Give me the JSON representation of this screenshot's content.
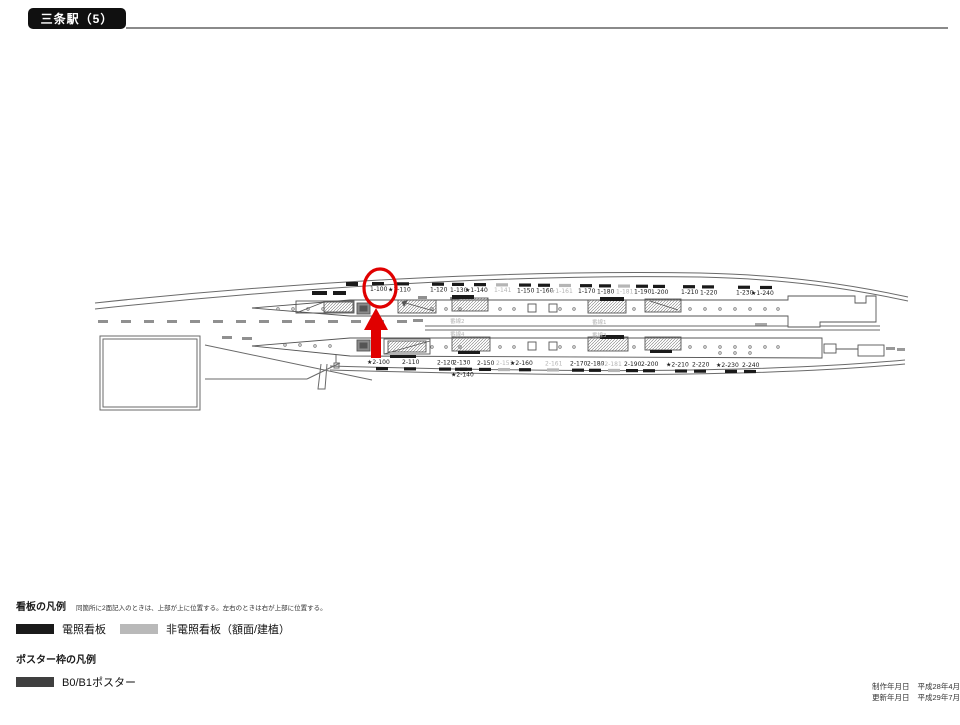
{
  "title": "三条駅（5）",
  "legend": {
    "signboard_heading": "看板の凡例",
    "signboard_note": "同箇所に2面記入のときは、上部が上に位置する。左右のときは右が上部に位置する。",
    "items": [
      {
        "label": "電照看板",
        "color": "#1a1a1a"
      },
      {
        "label": "非電照看板（額面/建植）",
        "color": "#b9b9b9"
      }
    ],
    "poster_heading": "ポスター枠の凡例",
    "poster_items": [
      {
        "label": "B0/B1ポスター",
        "color": "#3f3f3f"
      }
    ]
  },
  "footer": {
    "created_label": "制作年月日",
    "created_date": "平成28年4月 1日",
    "updated_label": "更新年月日",
    "updated_date": "平成29年7月12日"
  },
  "diagram": {
    "colors": {
      "billboard": "#1a1a1a",
      "non_lit": "#b5b5b5",
      "highlight": "#e00000"
    },
    "highlight": {
      "target": "1-100"
    },
    "track_labels": [
      {
        "text": "番線2",
        "x": 450,
        "y": 323
      },
      {
        "text": "番線1",
        "x": 592,
        "y": 324
      },
      {
        "text": "番線4",
        "x": 450,
        "y": 336
      },
      {
        "text": "番線3",
        "x": 592,
        "y": 337
      }
    ],
    "rows": [
      {
        "name": "row1",
        "baseY": 291,
        "x0": 370,
        "slope": 0.01,
        "tickdy": -9,
        "items": [
          {
            "id": "1-100",
            "x": 370
          },
          {
            "id": "1-110",
            "x": 395,
            "star": true
          },
          {
            "id": "1-120",
            "x": 430
          },
          {
            "id": "1-130",
            "x": 450
          },
          {
            "id": "1-140",
            "x": 472,
            "star": true
          },
          {
            "id": "1-141",
            "x": 494,
            "gray": true
          },
          {
            "id": "1-150",
            "x": 517
          },
          {
            "id": "1-160",
            "x": 536
          },
          {
            "id": "1-161",
            "x": 557,
            "star": true,
            "gray": true
          },
          {
            "id": "1-170",
            "x": 578
          },
          {
            "id": "1-180",
            "x": 597
          },
          {
            "id": "1-181",
            "x": 616,
            "gray": true
          },
          {
            "id": "1-190",
            "x": 634
          },
          {
            "id": "1-200",
            "x": 651
          },
          {
            "id": "1-210",
            "x": 681
          },
          {
            "id": "1-220",
            "x": 700
          },
          {
            "id": "1-230",
            "x": 736
          },
          {
            "id": "1-240",
            "x": 758,
            "star": true
          }
        ]
      },
      {
        "name": "row2",
        "baseY": 364,
        "x0": 374,
        "slope": 0.008,
        "tickdy": 3,
        "items": [
          {
            "id": "2-100",
            "x": 374,
            "star": true
          },
          {
            "id": "2-110",
            "x": 402
          },
          {
            "id": "2-120",
            "x": 437
          },
          {
            "id": "2-130",
            "x": 453
          },
          {
            "id": "2-140",
            "x": 458,
            "star": true,
            "dy": 12,
            "tdy": -9
          },
          {
            "id": "2-150",
            "x": 477
          },
          {
            "id": "2-151",
            "x": 496,
            "gray": true
          },
          {
            "id": "2-160",
            "x": 517,
            "star": true
          },
          {
            "id": "2-161",
            "x": 545,
            "gray": true
          },
          {
            "id": "2-170",
            "x": 570
          },
          {
            "id": "2-180",
            "x": 587
          },
          {
            "id": "2-181",
            "x": 606,
            "star": true,
            "gray": true
          },
          {
            "id": "2-190",
            "x": 624
          },
          {
            "id": "2-200",
            "x": 641
          },
          {
            "id": "2-210",
            "x": 673,
            "star": true
          },
          {
            "id": "2-220",
            "x": 692
          },
          {
            "id": "2-230",
            "x": 723,
            "star": true
          },
          {
            "id": "2-240",
            "x": 742
          }
        ]
      }
    ]
  }
}
